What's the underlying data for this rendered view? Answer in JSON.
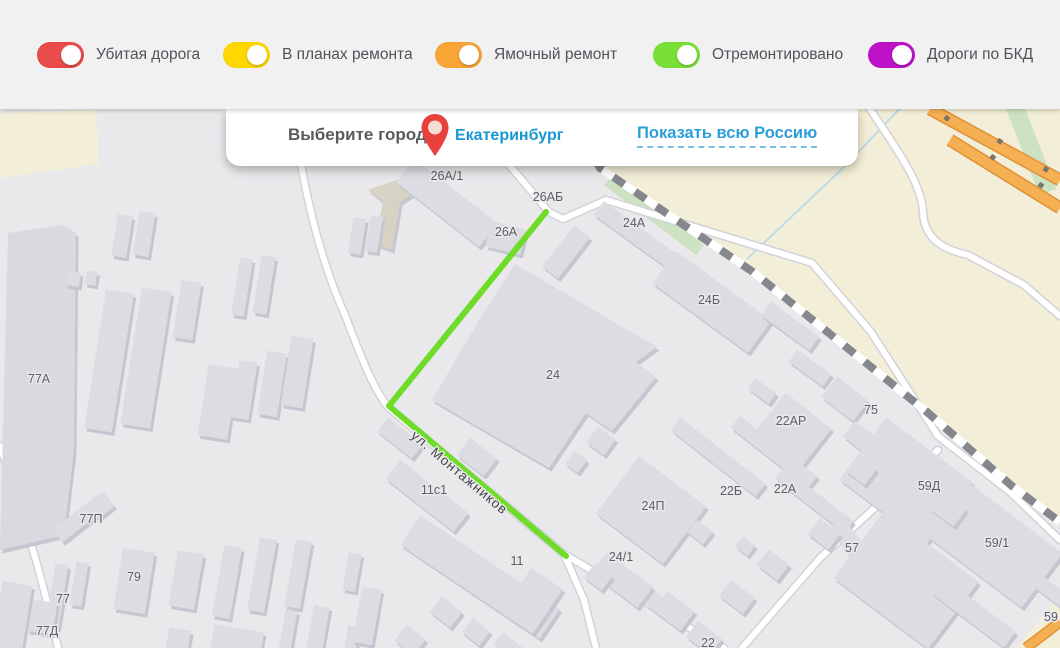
{
  "legend": {
    "toggles": [
      {
        "label": "Убитая дорога",
        "color": "#ea4b4b",
        "state": "on"
      },
      {
        "label": "В планах ремонта",
        "color": "#fed800",
        "state": "on"
      },
      {
        "label": "Ямочный ремонт",
        "color": "#f7a636",
        "state": "on"
      },
      {
        "label": "Отремонтировано",
        "color": "#79e136",
        "state": "on"
      },
      {
        "label": "Дороги по БКД",
        "color": "#bf12c8",
        "state": "on"
      }
    ]
  },
  "city_panel": {
    "label": "Выберите город:",
    "city": "Екатеринбург",
    "show_all_link": "Показать всю Россию",
    "pin_icon": "map-pin",
    "city_color": "#1897d3",
    "link_color": "#2d9fd8",
    "pin_color": "#e8403c"
  },
  "map": {
    "street_label": "ул. Монтажников",
    "highlight_road_color": "#6fdc2a",
    "repair_road_color": "#f4b052",
    "railway_color": "#86868d",
    "landuse_color": "#f3eed8",
    "building_labels": [
      {
        "text": "26А/1",
        "x": 447,
        "y": 180
      },
      {
        "text": "26АБ",
        "x": 548,
        "y": 201
      },
      {
        "text": "26А",
        "x": 506,
        "y": 236
      },
      {
        "text": "24А",
        "x": 634,
        "y": 227
      },
      {
        "text": "24Б",
        "x": 709,
        "y": 304
      },
      {
        "text": "24",
        "x": 553,
        "y": 379
      },
      {
        "text": "22АР",
        "x": 791,
        "y": 425
      },
      {
        "text": "75",
        "x": 871,
        "y": 414
      },
      {
        "text": "22Б",
        "x": 731,
        "y": 495
      },
      {
        "text": "22А",
        "x": 785,
        "y": 493
      },
      {
        "text": "59Д",
        "x": 929,
        "y": 490
      },
      {
        "text": "57",
        "x": 852,
        "y": 552
      },
      {
        "text": "59/1",
        "x": 997,
        "y": 547
      },
      {
        "text": "24П",
        "x": 653,
        "y": 510
      },
      {
        "text": "24/1",
        "x": 621,
        "y": 561
      },
      {
        "text": "11с1",
        "x": 434,
        "y": 494
      },
      {
        "text": "11",
        "x": 517,
        "y": 565
      },
      {
        "text": "22",
        "x": 708,
        "y": 647
      },
      {
        "text": "77А",
        "x": 39,
        "y": 383
      },
      {
        "text": "77П",
        "x": 91,
        "y": 523
      },
      {
        "text": "79",
        "x": 134,
        "y": 581
      },
      {
        "text": "77",
        "x": 63,
        "y": 603
      },
      {
        "text": "77Д",
        "x": 47,
        "y": 635
      },
      {
        "text": "59",
        "x": 1051,
        "y": 621
      }
    ]
  }
}
